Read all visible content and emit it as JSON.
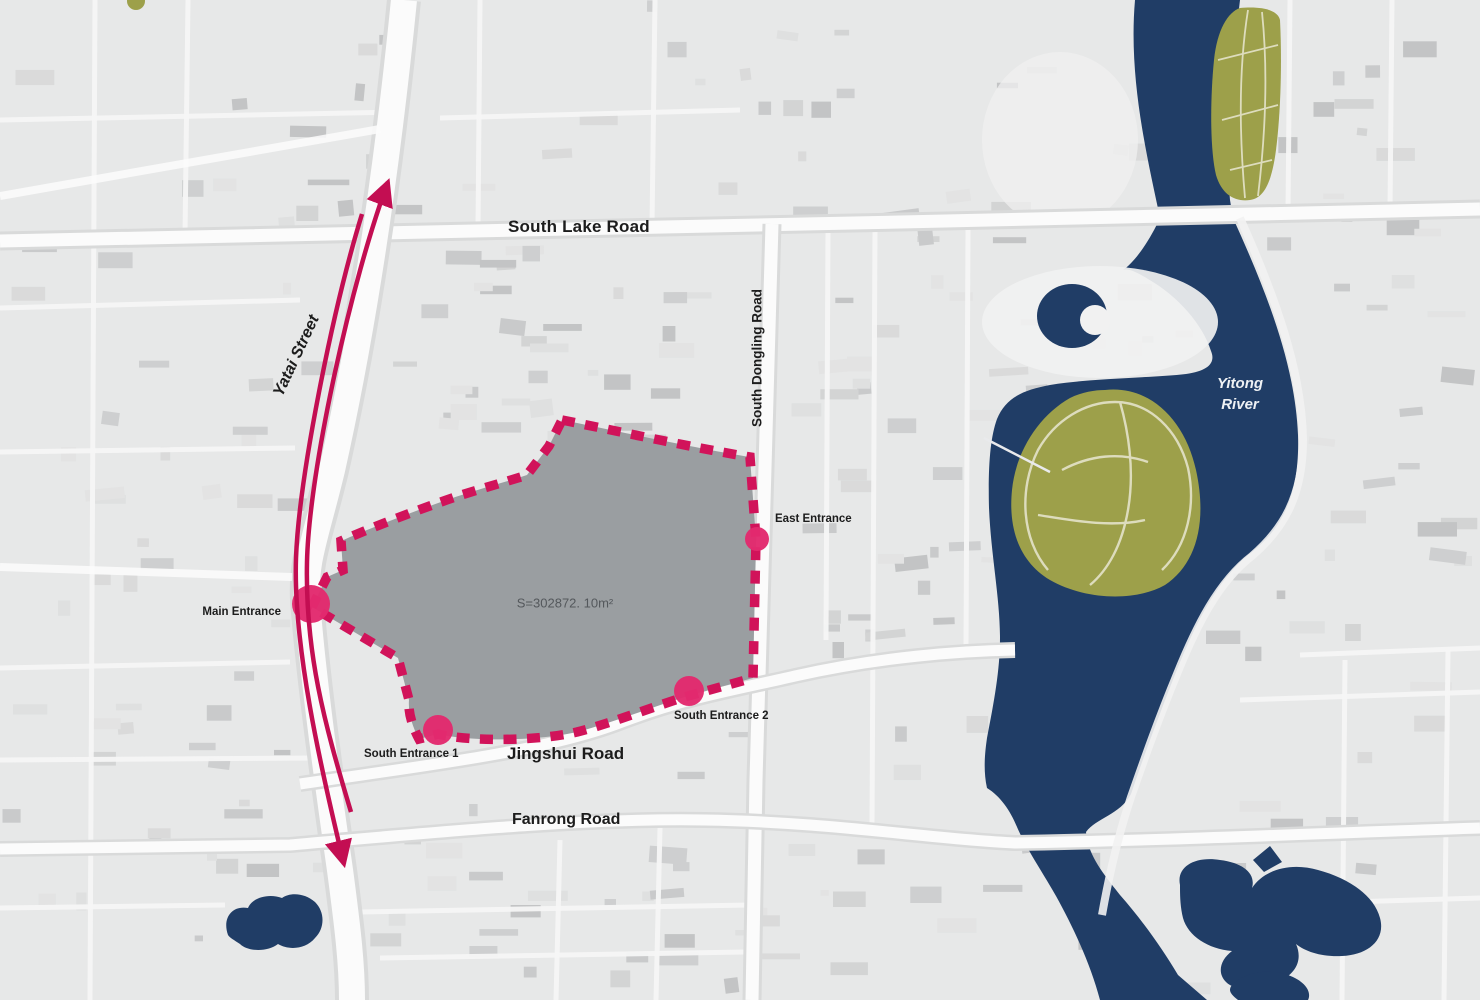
{
  "labels": {
    "south_lake_road": "South Lake Road",
    "yatai_street": "Yatai Street",
    "south_dongling_road": "South Dongling Road",
    "jingshui_road": "Jingshui Road",
    "fanrong_road": "Fanrong Road",
    "yitong_river_line1": "Yitong",
    "yitong_river_line2": "River",
    "main_entrance": "Main Entrance",
    "east_entrance": "East Entrance",
    "south_entrance_1": "South Entrance 1",
    "south_entrance_2": "South Entrance 2",
    "site_area": "S=302872. 10m²"
  },
  "colors": {
    "site_boundary": "#d1135a",
    "entrance_marker": "#e22a6e",
    "site_fill": "#9a9ea1",
    "river": "#203d66",
    "park_green": "#9da04a",
    "traffic_arrow": "#c30e52",
    "road": "#fbfbfb",
    "land": "#e7e8e8",
    "label_text": "#1c1c1c",
    "area_text": "#54585c",
    "river_label_text": "#eef1f4"
  }
}
